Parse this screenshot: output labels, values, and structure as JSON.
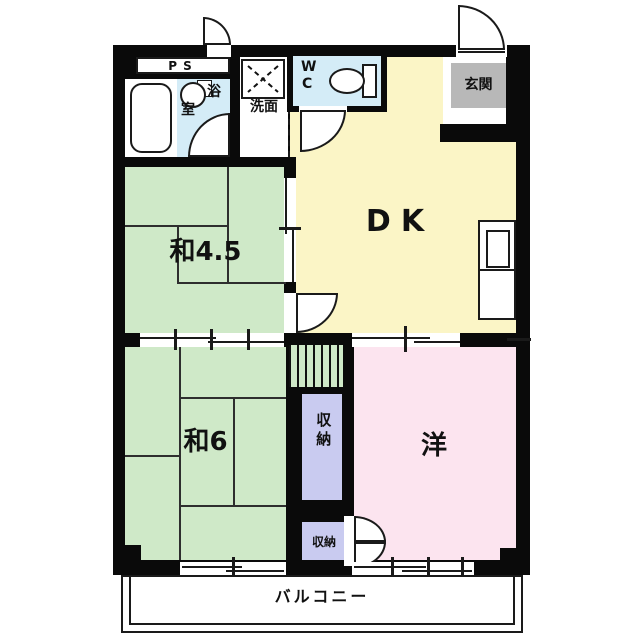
{
  "title": "apartment-floor-plan",
  "colors": {
    "wall": "#0a0a0a",
    "tatami_green": "#cfe9c8",
    "dk_yellow": "#fbf5c6",
    "western_pink": "#fce4ef",
    "storage_lavender": "#c9cbf0",
    "wet_area_blue": "#d4ecf7",
    "entry_gray": "#b8b8b8"
  },
  "rooms": {
    "ps": {
      "label": "PS"
    },
    "bath": {
      "char1": "浴",
      "char2": "室"
    },
    "washroom": {
      "label": "洗面"
    },
    "wc": {
      "line1": "W",
      "line2": "C"
    },
    "entry": {
      "label": "玄関"
    },
    "dk": {
      "label": "DK"
    },
    "japanese_45": {
      "label": "和4.5"
    },
    "japanese_6": {
      "label": "和6"
    },
    "western": {
      "label": "洋"
    },
    "storage_upper": {
      "label": "収納"
    },
    "storage_lower": {
      "label": "収納"
    },
    "balcony": {
      "label": "バルコニー"
    }
  }
}
